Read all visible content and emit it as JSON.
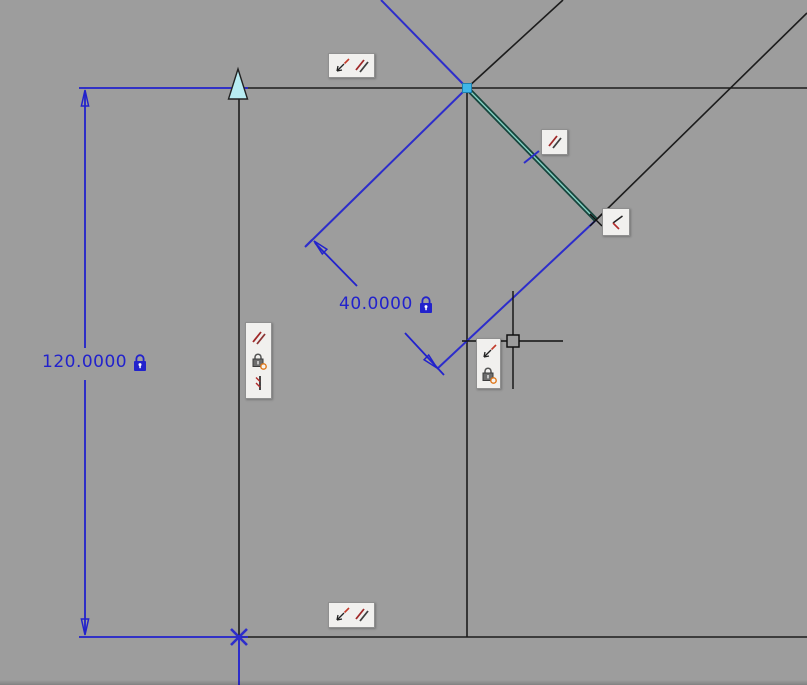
{
  "app": {
    "name": "CAD sketch canvas",
    "background_color": "#9d9d9d"
  },
  "dimensions": [
    {
      "name": "vertical-dimension",
      "value": "120.0000",
      "locked": true
    },
    {
      "name": "aligned-dimension",
      "value": "40.0000",
      "locked": true
    }
  ],
  "constraint_badges": [
    {
      "name": "badge-top-edge",
      "icons": [
        "coincident-icon",
        "parallel-icon"
      ]
    },
    {
      "name": "badge-selected-line",
      "icons": [
        "parallel-icon"
      ]
    },
    {
      "name": "badge-right-corner",
      "icons": [
        "perpendicular-icon"
      ]
    },
    {
      "name": "badge-left-edge",
      "icons": [
        "parallel-icon",
        "lock-icon",
        "collinear-icon"
      ]
    },
    {
      "name": "badge-cursor",
      "icons": [
        "coincident-icon",
        "lock-icon"
      ]
    },
    {
      "name": "badge-bottom-edge",
      "icons": [
        "coincident-icon",
        "parallel-icon"
      ]
    }
  ],
  "cursor": {
    "type": "crosshair",
    "x": 513,
    "y": 341
  },
  "markers": [
    {
      "name": "endpoint-triangle-marker",
      "x": 238,
      "y": 88
    },
    {
      "name": "vertex-point-marker",
      "x": 467,
      "y": 88
    },
    {
      "name": "origin-x-marker",
      "x": 239,
      "y": 637
    }
  ],
  "colors": {
    "sketch_blue": "#2d2dcb",
    "dimension_blue": "#2222cc",
    "geometry_black": "#1c1c1c",
    "selected_line": "#17453d",
    "selected_core": "#86d2c5",
    "vertex_fill": "#3fb6e8",
    "marker_fill": "#b8ecf2",
    "badge_background": "#f1f0ee"
  }
}
